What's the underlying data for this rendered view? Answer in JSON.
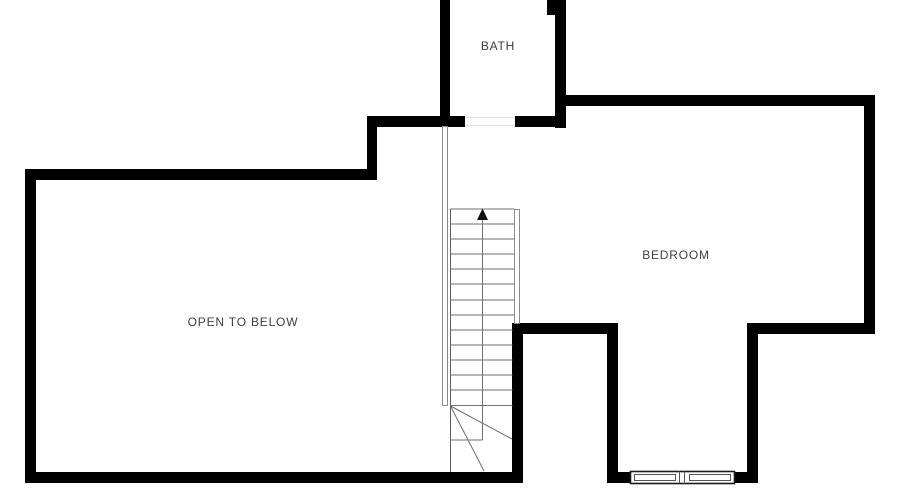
{
  "rooms": [
    {
      "name": "bath",
      "label": "BATH"
    },
    {
      "name": "bedroom",
      "label": "BEDROOM"
    },
    {
      "name": "open_to_below",
      "label": "OPEN TO BELOW"
    }
  ],
  "stairs": {
    "direction": "up",
    "arrow_icon": "up-arrow",
    "tread_count": 14
  },
  "colors": {
    "wall": "#000000",
    "stair_line": "#6f6f6f",
    "thin_wall_stroke": "#8c8c8c",
    "window_frame": "#1a1a1a",
    "window_inner": "#555555",
    "label_text": "#3d3d3d",
    "background": "#ffffff",
    "door_threshold": "#e0e0e0"
  }
}
